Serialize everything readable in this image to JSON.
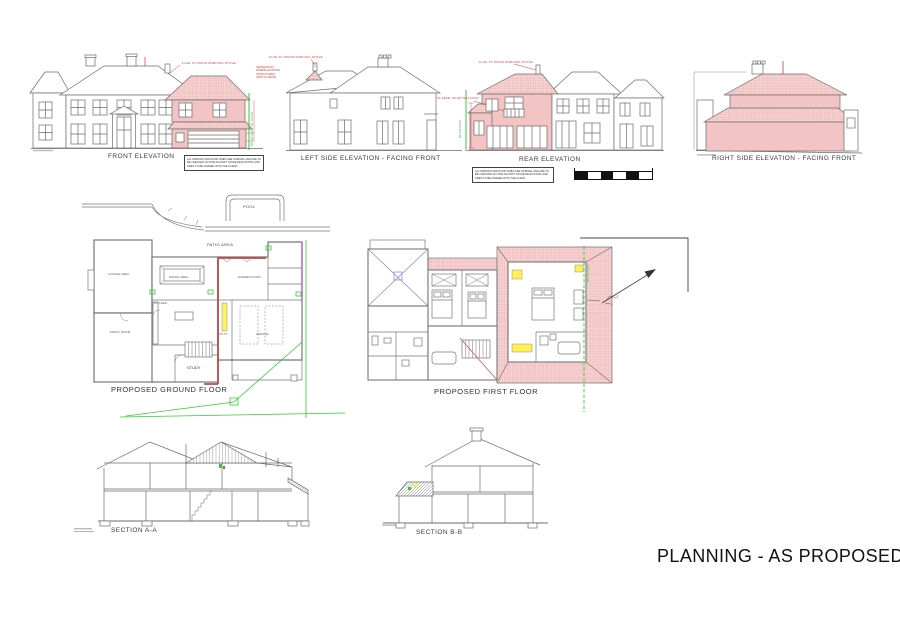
{
  "title": "PLANNING - AS PROPOSED",
  "general_note": "ALL WINDOW AND DOOR SIZES ARE NOMINAL AND ARE TO BE CHECKED ON SITE AGAINST THOSE RE EXISTING AND SIZES TO BE AGREED WITH THE CLIENT.",
  "elevations": {
    "front": {
      "label": "FRONT ELEVATION"
    },
    "left_side": {
      "label": "LEFT SIDE ELEVATION - FACING FRONT"
    },
    "rear": {
      "label": "REAR ELEVATION"
    },
    "right_side": {
      "label": "RIGHT SIDE ELEVATION - FACING FRONT"
    }
  },
  "annotations": {
    "flue": "FLUE TO WOOD BURNING STOVE",
    "separation": [
      "SEPARATION",
      "WHERE EXISTING",
      "STRUCTURES",
      "ABUT AT REAR"
    ],
    "boundary_at_rear": "BOUNDARY AT REAR",
    "boundary": "BOUNDARY",
    "juliet_balcony": "GLAZED JULIET BALCONY"
  },
  "plans": {
    "ground": {
      "label": "PROPOSED GROUND FLOOR",
      "pool": "POOL",
      "patio": "PATIO AREA",
      "rooms": {
        "lounge": "LOUNGE AREA",
        "family": "FAMILY ROOM",
        "dining": "DINING AREA",
        "kitchen": "KITCHEN",
        "garden": "GARDEN ROOM",
        "garage": "GARAGE",
        "utility": "UTILITY",
        "study": "STUDY"
      }
    },
    "first": {
      "label": "PROPOSED FIRST FLOOR",
      "boundary": "BOUNDARY"
    }
  },
  "sections": {
    "a": {
      "label": "SECTION A-A"
    },
    "b": {
      "label": "SECTION B-B"
    }
  },
  "colors": {
    "proposed_wall": "#f2c4c4",
    "proposed_roof": "#f7d2d2",
    "line": "#6b6b6b",
    "annotation_red": "#cf3a36",
    "new_wall_red": "#bf4a44",
    "boundary_green": "#2eb82e",
    "survey_green": "#33cc33",
    "boundary_magenta": "#c455c4",
    "highlight_yellow": "#ffee44",
    "rooflight_blue": "#8585d6"
  }
}
